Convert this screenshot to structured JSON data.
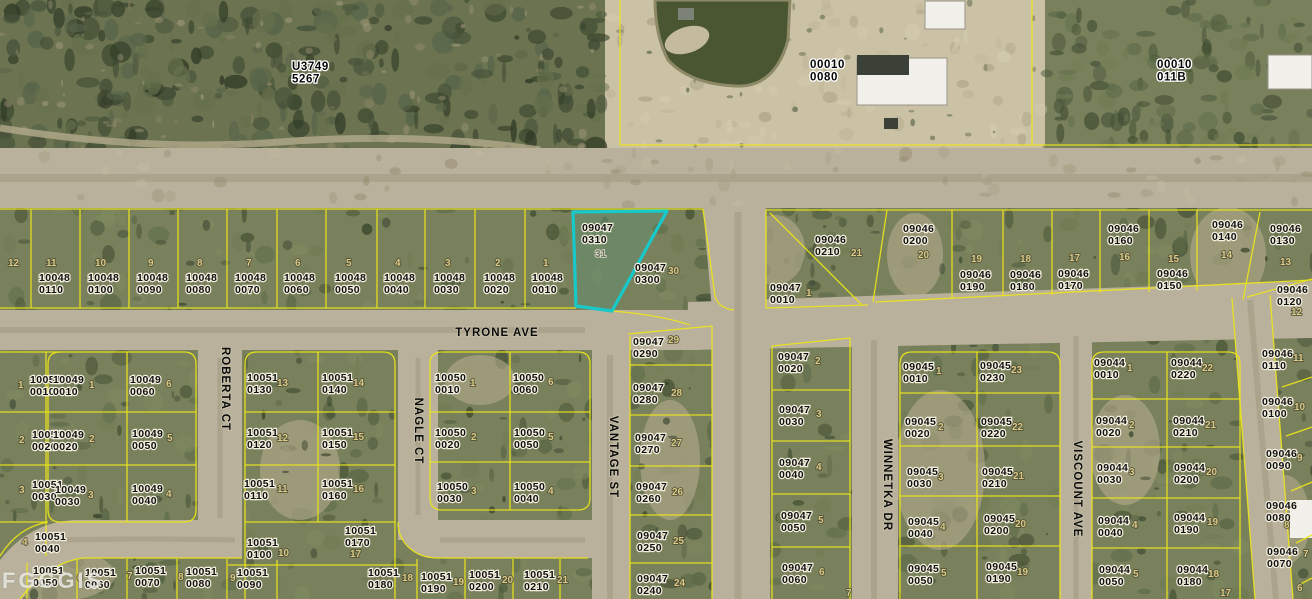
{
  "map": {
    "watermark": "FGCGIS",
    "colors": {
      "land_olive": "#79815c",
      "land_dark_nw": "#6b7350",
      "road_tan": "#b9b19c",
      "sand": "#cbc2a5",
      "pond": "#4a5531",
      "boundary_yellow": "#ece51a",
      "highlight_cyan": "#17c9c9",
      "label_black": "#101010",
      "lot_khaki": "#d9cb87",
      "building_white": "#f2f0ea"
    },
    "highlighted_parcel": {
      "id": "09047 0310",
      "lot": "31"
    },
    "section_labels": [
      {
        "line1": "U3749",
        "line2": "5267",
        "x": 292,
        "y": 70
      },
      {
        "line1": "00010",
        "line2": "0080",
        "x": 810,
        "y": 68
      },
      {
        "line1": "00010",
        "line2": "011B",
        "x": 1157,
        "y": 68
      }
    ],
    "streets": [
      {
        "name": "TYRONE AVE",
        "x": 497,
        "y": 336,
        "rotate": 0
      },
      {
        "name": "ROBERTA CT",
        "x": 222,
        "y": 389,
        "rotate": 90
      },
      {
        "name": "NAGLE CT",
        "x": 415,
        "y": 431,
        "rotate": 90
      },
      {
        "name": "VANTAGE ST",
        "x": 610,
        "y": 457,
        "rotate": 90
      },
      {
        "name": "WINNETKA DR",
        "x": 884,
        "y": 485,
        "rotate": 90
      },
      {
        "name": "VISCOUNT AVE",
        "x": 1074,
        "y": 489,
        "rotate": 90
      }
    ],
    "parcels": [
      {
        "code": "",
        "num": "",
        "x": 0,
        "y": 0,
        "lot": "12",
        "lx": 8,
        "ly": 266
      },
      {
        "code": "10048",
        "num": "0110",
        "x": 39,
        "y": 281,
        "lot": "11",
        "lx": 46,
        "ly": 266
      },
      {
        "code": "10048",
        "num": "0100",
        "x": 88,
        "y": 281,
        "lot": "10",
        "lx": 95,
        "ly": 266
      },
      {
        "code": "10048",
        "num": "0090",
        "x": 137,
        "y": 281,
        "lot": "9",
        "lx": 148,
        "ly": 266
      },
      {
        "code": "10048",
        "num": "0080",
        "x": 186,
        "y": 281,
        "lot": "8",
        "lx": 197,
        "ly": 266
      },
      {
        "code": "10048",
        "num": "0070",
        "x": 235,
        "y": 281,
        "lot": "7",
        "lx": 246,
        "ly": 266
      },
      {
        "code": "10048",
        "num": "0060",
        "x": 284,
        "y": 281,
        "lot": "6",
        "lx": 295,
        "ly": 266
      },
      {
        "code": "10048",
        "num": "0050",
        "x": 335,
        "y": 281,
        "lot": "5",
        "lx": 346,
        "ly": 266
      },
      {
        "code": "10048",
        "num": "0040",
        "x": 384,
        "y": 281,
        "lot": "4",
        "lx": 395,
        "ly": 266
      },
      {
        "code": "10048",
        "num": "0030",
        "x": 434,
        "y": 281,
        "lot": "3",
        "lx": 445,
        "ly": 266
      },
      {
        "code": "10048",
        "num": "0020",
        "x": 484,
        "y": 281,
        "lot": "2",
        "lx": 495,
        "ly": 266
      },
      {
        "code": "10048",
        "num": "0010",
        "x": 532,
        "y": 281,
        "lot": "1",
        "lx": 543,
        "ly": 266
      },
      {
        "code": "09047",
        "num": "0310",
        "x": 582,
        "y": 231,
        "lot": "31",
        "lx": 595,
        "ly": 257,
        "dark": true
      },
      {
        "code": "09047",
        "num": "0300",
        "x": 635,
        "y": 271,
        "lot": "30",
        "lx": 668,
        "ly": 274
      },
      {
        "code": "09046",
        "num": "0210",
        "x": 815,
        "y": 243,
        "lot": "21",
        "lx": 851,
        "ly": 256
      },
      {
        "code": "09046",
        "num": "0200",
        "x": 903,
        "y": 232,
        "lot": "20",
        "lx": 918,
        "ly": 258
      },
      {
        "code": "09046",
        "num": "0190",
        "x": 960,
        "y": 278,
        "lot": "19",
        "lx": 971,
        "ly": 262
      },
      {
        "code": "09046",
        "num": "0180",
        "x": 1010,
        "y": 278,
        "lot": "18",
        "lx": 1020,
        "ly": 262
      },
      {
        "code": "09046",
        "num": "0170",
        "x": 1058,
        "y": 277,
        "lot": "17",
        "lx": 1069,
        "ly": 261
      },
      {
        "code": "09046",
        "num": "0160",
        "x": 1108,
        "y": 232,
        "lot": "16",
        "lx": 1119,
        "ly": 260
      },
      {
        "code": "09046",
        "num": "0150",
        "x": 1157,
        "y": 277,
        "lot": "15",
        "lx": 1168,
        "ly": 262
      },
      {
        "code": "09046",
        "num": "0140",
        "x": 1212,
        "y": 228,
        "lot": "14",
        "lx": 1221,
        "ly": 258
      },
      {
        "code": "09046",
        "num": "0130",
        "x": 1270,
        "y": 232,
        "lot": "13",
        "lx": 1280,
        "ly": 265
      },
      {
        "code": "09046",
        "num": "0120",
        "x": 1277,
        "y": 293,
        "lot": "12",
        "lx": 1291,
        "ly": 315
      },
      {
        "code": "09047",
        "num": "0010",
        "x": 770,
        "y": 291,
        "lot": "1",
        "lx": 806,
        "ly": 296
      },
      {
        "code": "10051",
        "num": "0010",
        "x": 30,
        "y": 383,
        "lot": "1",
        "lx": 18,
        "ly": 388
      },
      {
        "code": "10051",
        "num": "0020",
        "x": 32,
        "y": 438,
        "lot": "2",
        "lx": 19,
        "ly": 443
      },
      {
        "code": "10051",
        "num": "0030",
        "x": 32,
        "y": 488,
        "lot": "3",
        "lx": 19,
        "ly": 493
      },
      {
        "code": "10051",
        "num": "0040",
        "x": 35,
        "y": 540,
        "lot": "4",
        "lx": 22,
        "ly": 545
      },
      {
        "code": "10049",
        "num": "0010",
        "x": 53,
        "y": 383,
        "lot": "1",
        "lx": 89,
        "ly": 388
      },
      {
        "code": "10049",
        "num": "0060",
        "x": 130,
        "y": 383,
        "lot": "6",
        "lx": 166,
        "ly": 387
      },
      {
        "code": "10049",
        "num": "0020",
        "x": 53,
        "y": 438,
        "lot": "2",
        "lx": 89,
        "ly": 442
      },
      {
        "code": "10049",
        "num": "0050",
        "x": 132,
        "y": 437,
        "lot": "5",
        "lx": 167,
        "ly": 441
      },
      {
        "code": "10049",
        "num": "0030",
        "x": 55,
        "y": 493,
        "lot": "3",
        "lx": 88,
        "ly": 498
      },
      {
        "code": "10049",
        "num": "0040",
        "x": 132,
        "y": 492,
        "lot": "4",
        "lx": 166,
        "ly": 497
      },
      {
        "code": "10051",
        "num": "0130",
        "x": 247,
        "y": 381,
        "lot": "13",
        "lx": 277,
        "ly": 386
      },
      {
        "code": "10051",
        "num": "0140",
        "x": 322,
        "y": 381,
        "lot": "14",
        "lx": 353,
        "ly": 386
      },
      {
        "code": "10051",
        "num": "0120",
        "x": 247,
        "y": 436,
        "lot": "12",
        "lx": 277,
        "ly": 441
      },
      {
        "code": "10051",
        "num": "0150",
        "x": 322,
        "y": 436,
        "lot": "15",
        "lx": 353,
        "ly": 440
      },
      {
        "code": "10051",
        "num": "0110",
        "x": 244,
        "y": 487,
        "lot": "11",
        "lx": 277,
        "ly": 492
      },
      {
        "code": "10051",
        "num": "0160",
        "x": 322,
        "y": 487,
        "lot": "16",
        "lx": 353,
        "ly": 492
      },
      {
        "code": "10051",
        "num": "0100",
        "x": 247,
        "y": 546,
        "lot": "10",
        "lx": 278,
        "ly": 556
      },
      {
        "code": "10051",
        "num": "0170",
        "x": 345,
        "y": 534,
        "lot": "17",
        "lx": 350,
        "ly": 557
      },
      {
        "code": "10051",
        "num": "0090",
        "x": 237,
        "y": 576,
        "lot": "9",
        "lx": 230,
        "ly": 581
      },
      {
        "code": "10051",
        "num": "0050",
        "x": 33,
        "y": 574,
        "lot": "",
        "lx": 0,
        "ly": 0
      },
      {
        "code": "10051",
        "num": "0060",
        "x": 85,
        "y": 576,
        "lot": "6",
        "lx": 77,
        "ly": 581
      },
      {
        "code": "10051",
        "num": "0070",
        "x": 135,
        "y": 574,
        "lot": "7",
        "lx": 127,
        "ly": 579
      },
      {
        "code": "10051",
        "num": "0080",
        "x": 186,
        "y": 575,
        "lot": "8",
        "lx": 178,
        "ly": 580
      },
      {
        "code": "10051",
        "num": "0180",
        "x": 368,
        "y": 576,
        "lot": "18",
        "lx": 402,
        "ly": 581
      },
      {
        "code": "10051",
        "num": "0190",
        "x": 421,
        "y": 580,
        "lot": "19",
        "lx": 453,
        "ly": 585
      },
      {
        "code": "10051",
        "num": "0200",
        "x": 469,
        "y": 578,
        "lot": "20",
        "lx": 502,
        "ly": 583
      },
      {
        "code": "10051",
        "num": "0210",
        "x": 524,
        "y": 578,
        "lot": "21",
        "lx": 557,
        "ly": 583
      },
      {
        "code": "10050",
        "num": "0010",
        "x": 435,
        "y": 381,
        "lot": "1",
        "lx": 470,
        "ly": 386
      },
      {
        "code": "10050",
        "num": "0060",
        "x": 513,
        "y": 381,
        "lot": "6",
        "lx": 548,
        "ly": 385
      },
      {
        "code": "10050",
        "num": "0020",
        "x": 435,
        "y": 436,
        "lot": "2",
        "lx": 471,
        "ly": 440
      },
      {
        "code": "10050",
        "num": "0050",
        "x": 514,
        "y": 436,
        "lot": "5",
        "lx": 548,
        "ly": 440
      },
      {
        "code": "10050",
        "num": "0030",
        "x": 437,
        "y": 490,
        "lot": "3",
        "lx": 471,
        "ly": 494
      },
      {
        "code": "10050",
        "num": "0040",
        "x": 514,
        "y": 490,
        "lot": "4",
        "lx": 548,
        "ly": 494
      },
      {
        "code": "09047",
        "num": "0290",
        "x": 633,
        "y": 345,
        "lot": "29",
        "lx": 668,
        "ly": 343
      },
      {
        "code": "09047",
        "num": "0280",
        "x": 633,
        "y": 391,
        "lot": "28",
        "lx": 671,
        "ly": 396
      },
      {
        "code": "09047",
        "num": "0270",
        "x": 635,
        "y": 441,
        "lot": "27",
        "lx": 671,
        "ly": 446
      },
      {
        "code": "09047",
        "num": "0260",
        "x": 636,
        "y": 490,
        "lot": "26",
        "lx": 672,
        "ly": 495
      },
      {
        "code": "09047",
        "num": "0250",
        "x": 637,
        "y": 539,
        "lot": "25",
        "lx": 673,
        "ly": 544
      },
      {
        "code": "09047",
        "num": "0240",
        "x": 637,
        "y": 582,
        "lot": "24",
        "lx": 674,
        "ly": 586
      },
      {
        "code": "09047",
        "num": "0020",
        "x": 778,
        "y": 360,
        "lot": "2",
        "lx": 815,
        "ly": 364
      },
      {
        "code": "09047",
        "num": "0030",
        "x": 779,
        "y": 413,
        "lot": "3",
        "lx": 816,
        "ly": 417
      },
      {
        "code": "09047",
        "num": "0040",
        "x": 779,
        "y": 466,
        "lot": "4",
        "lx": 816,
        "ly": 470
      },
      {
        "code": "09047",
        "num": "0050",
        "x": 781,
        "y": 519,
        "lot": "5",
        "lx": 818,
        "ly": 523
      },
      {
        "code": "09047",
        "num": "0060",
        "x": 782,
        "y": 571,
        "lot": "6",
        "lx": 819,
        "ly": 575
      },
      {
        "code": "",
        "num": "",
        "x": 0,
        "y": 0,
        "lot": "7",
        "lx": 846,
        "ly": 596
      },
      {
        "code": "09045",
        "num": "0010",
        "x": 903,
        "y": 370,
        "lot": "1",
        "lx": 936,
        "ly": 374
      },
      {
        "code": "09045",
        "num": "0020",
        "x": 905,
        "y": 425,
        "lot": "2",
        "lx": 938,
        "ly": 430
      },
      {
        "code": "09045",
        "num": "0030",
        "x": 907,
        "y": 475,
        "lot": "3",
        "lx": 938,
        "ly": 480
      },
      {
        "code": "09045",
        "num": "0040",
        "x": 908,
        "y": 525,
        "lot": "4",
        "lx": 940,
        "ly": 530
      },
      {
        "code": "09045",
        "num": "0050",
        "x": 908,
        "y": 572,
        "lot": "5",
        "lx": 941,
        "ly": 576
      },
      {
        "code": "09045",
        "num": "0230",
        "x": 980,
        "y": 369,
        "lot": "23",
        "lx": 1011,
        "ly": 373
      },
      {
        "code": "09045",
        "num": "0220",
        "x": 981,
        "y": 425,
        "lot": "22",
        "lx": 1012,
        "ly": 430
      },
      {
        "code": "09045",
        "num": "0210",
        "x": 982,
        "y": 475,
        "lot": "21",
        "lx": 1013,
        "ly": 479
      },
      {
        "code": "09045",
        "num": "0200",
        "x": 984,
        "y": 522,
        "lot": "20",
        "lx": 1015,
        "ly": 527
      },
      {
        "code": "09045",
        "num": "0190",
        "x": 986,
        "y": 570,
        "lot": "19",
        "lx": 1017,
        "ly": 575
      },
      {
        "code": "09044",
        "num": "0010",
        "x": 1094,
        "y": 366,
        "lot": "1",
        "lx": 1127,
        "ly": 371
      },
      {
        "code": "09044",
        "num": "0020",
        "x": 1096,
        "y": 424,
        "lot": "2",
        "lx": 1129,
        "ly": 428
      },
      {
        "code": "09044",
        "num": "0030",
        "x": 1097,
        "y": 471,
        "lot": "3",
        "lx": 1129,
        "ly": 475
      },
      {
        "code": "09044",
        "num": "0040",
        "x": 1098,
        "y": 524,
        "lot": "4",
        "lx": 1132,
        "ly": 528
      },
      {
        "code": "09044",
        "num": "0050",
        "x": 1099,
        "y": 573,
        "lot": "5",
        "lx": 1133,
        "ly": 577
      },
      {
        "code": "09044",
        "num": "0220",
        "x": 1171,
        "y": 366,
        "lot": "22",
        "lx": 1202,
        "ly": 371
      },
      {
        "code": "09044",
        "num": "0210",
        "x": 1173,
        "y": 424,
        "lot": "21",
        "lx": 1205,
        "ly": 428
      },
      {
        "code": "09044",
        "num": "0200",
        "x": 1174,
        "y": 471,
        "lot": "20",
        "lx": 1206,
        "ly": 475
      },
      {
        "code": "09044",
        "num": "0190",
        "x": 1174,
        "y": 521,
        "lot": "19",
        "lx": 1207,
        "ly": 525
      },
      {
        "code": "09044",
        "num": "0180",
        "x": 1177,
        "y": 573,
        "lot": "18",
        "lx": 1208,
        "ly": 577
      },
      {
        "code": "",
        "num": "",
        "x": 0,
        "y": 0,
        "lot": "17",
        "lx": 1220,
        "ly": 596
      },
      {
        "code": "09046",
        "num": "0110",
        "x": 1262,
        "y": 357,
        "lot": "11",
        "lx": 1293,
        "ly": 361
      },
      {
        "code": "09046",
        "num": "0100",
        "x": 1262,
        "y": 405,
        "lot": "10",
        "lx": 1294,
        "ly": 410
      },
      {
        "code": "09046",
        "num": "0090",
        "x": 1266,
        "y": 457,
        "lot": "9",
        "lx": 1297,
        "ly": 461
      },
      {
        "code": "09046",
        "num": "0080",
        "x": 1266,
        "y": 509,
        "lot": "8",
        "lx": 1284,
        "ly": 528
      },
      {
        "code": "09046",
        "num": "0070",
        "x": 1267,
        "y": 555,
        "lot": "7",
        "lx": 1303,
        "ly": 557
      },
      {
        "code": "",
        "num": "",
        "x": 0,
        "y": 0,
        "lot": "6",
        "lx": 1297,
        "ly": 591
      }
    ]
  }
}
